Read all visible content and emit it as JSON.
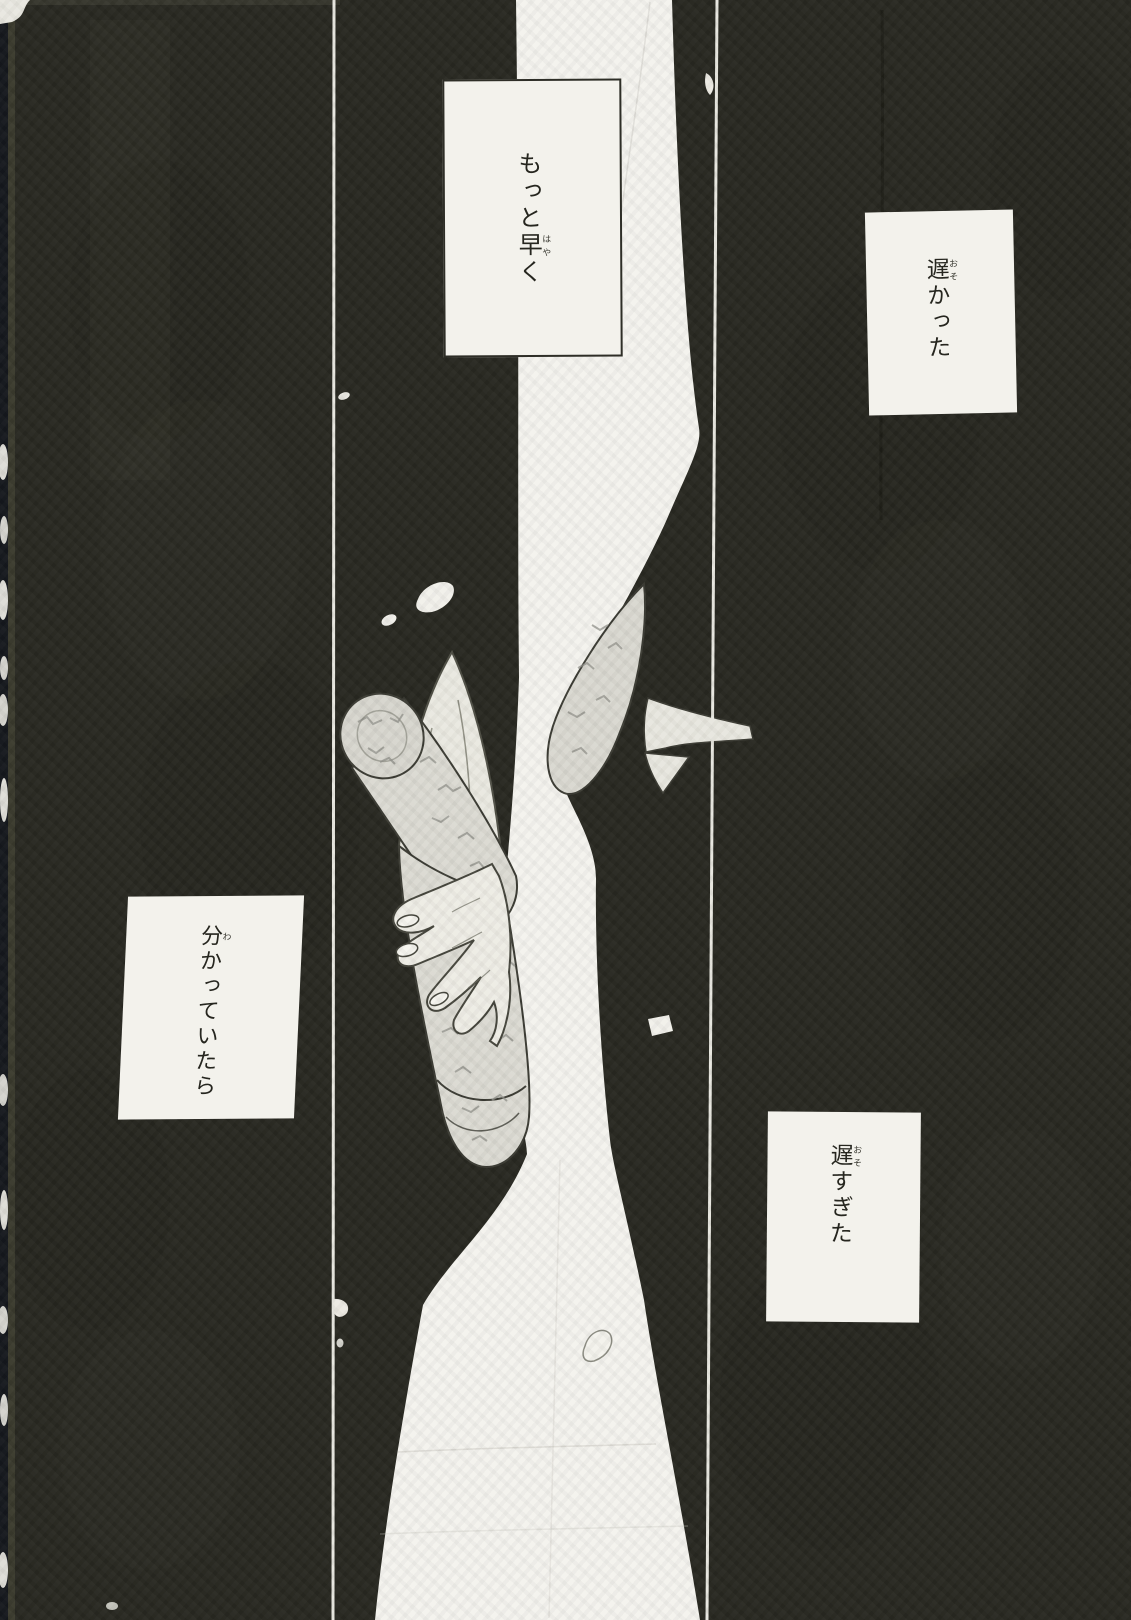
{
  "page": {
    "type": "manga-page",
    "colors": {
      "background_black": "#282821",
      "paper_white": "#f3f2ec",
      "ink": "#26261f",
      "panel_divider": "#e8e7e0",
      "screentone_gray": "#dbdad2"
    }
  },
  "captions": [
    {
      "name": "caption-top-center",
      "pre": "もっと",
      "kanji": "早",
      "furigana": "はや",
      "post": "く",
      "text": "もっと早く"
    },
    {
      "name": "caption-top-right",
      "pre": "",
      "kanji": "遅",
      "furigana": "おそ",
      "post": "かった",
      "text": "遅かった"
    },
    {
      "name": "caption-middle-left",
      "pre": "",
      "kanji": "分",
      "furigana": "わ",
      "post": "かっていたら",
      "text": "分かっていたら"
    },
    {
      "name": "caption-bottom-right",
      "pre": "",
      "kanji": "遅",
      "furigana": "おそ",
      "post": "すぎた",
      "text": "遅すぎた"
    }
  ],
  "artwork": {
    "elements": [
      "pale-tree-trunk-silhouette",
      "black-suited-figure-silhouette",
      "hand-gripping-rolled-scroll",
      "screentoned-rolled-scroll",
      "kimono-sleeve",
      "shirt-collar",
      "falling-petals",
      "panel-divider-lines",
      "scanned-page-edge-specks"
    ]
  }
}
